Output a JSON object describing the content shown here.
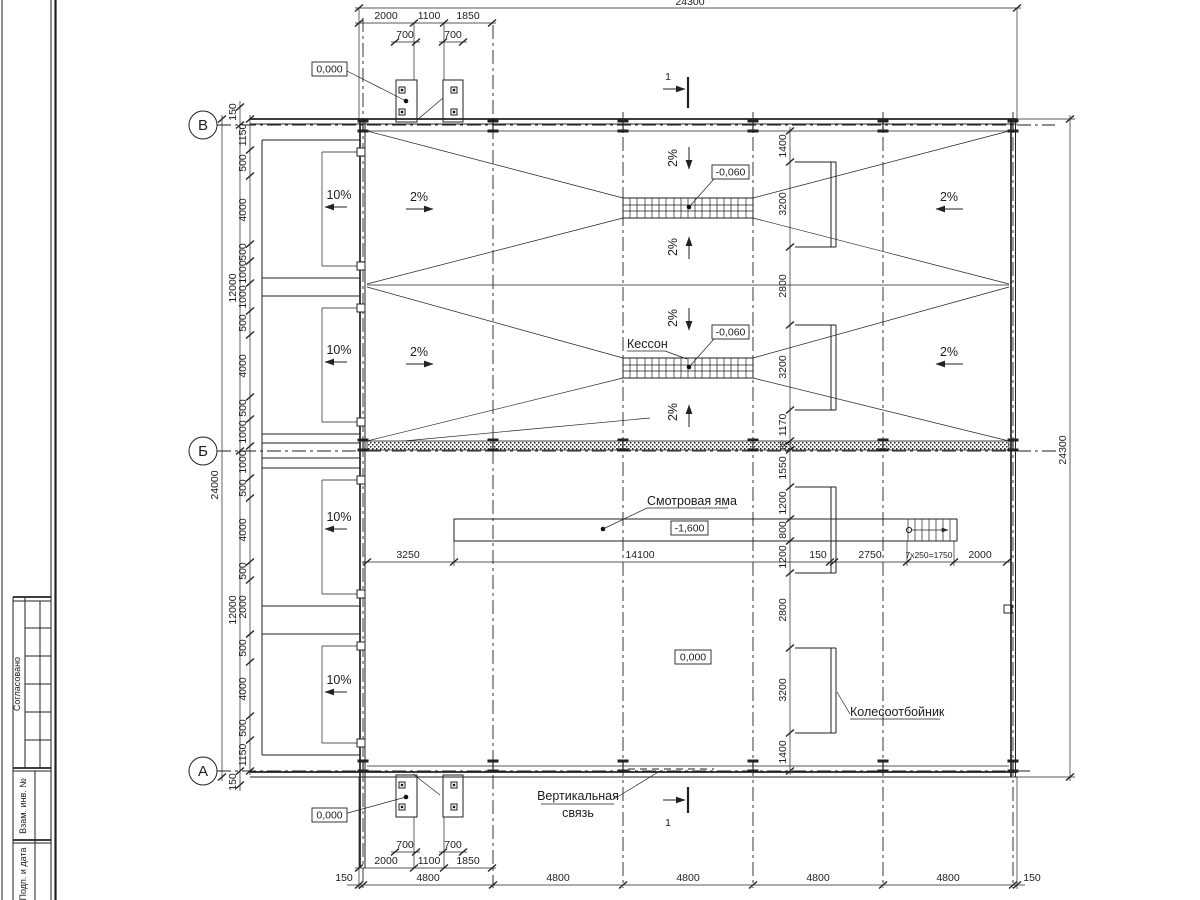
{
  "axes": {
    "top": "В",
    "middle": "Б",
    "bottom": "А"
  },
  "levels": {
    "zero": "0,000",
    "minus060": "-0,060",
    "minus1600": "-1,600"
  },
  "labels": {
    "caisson": "Кессон",
    "pit": "Смотровая яма",
    "wheel_guard": "Колесоотбойник",
    "brace1": "Вертикальная",
    "brace2": "связь",
    "section": "1"
  },
  "slopes": {
    "cross": "2%",
    "ramp": "10%"
  },
  "dims": {
    "total": "24300",
    "inner": "24000",
    "half": "12000",
    "margin": "150",
    "bay": "4800",
    "a2000": "2000",
    "a1100": "1100",
    "a1850": "1850",
    "a700": "700",
    "a1150": "1150",
    "a500": "500",
    "a4000": "4000",
    "a1000": "1000",
    "a1400": "1400",
    "a3200": "3200",
    "a2800": "2800",
    "a1170": "1170",
    "a80": "80",
    "a1550": "1550",
    "a1200": "1200",
    "a800": "800",
    "a3250": "3250",
    "a14100": "14100",
    "a2750": "2750",
    "steps": "7х250=1750"
  },
  "titleblock": {
    "approved": "Согласовано",
    "inv": "Взам. инв. №",
    "date": "Подп. и дата"
  },
  "colors": {
    "ink": "#222222",
    "paper": "#ffffff"
  }
}
